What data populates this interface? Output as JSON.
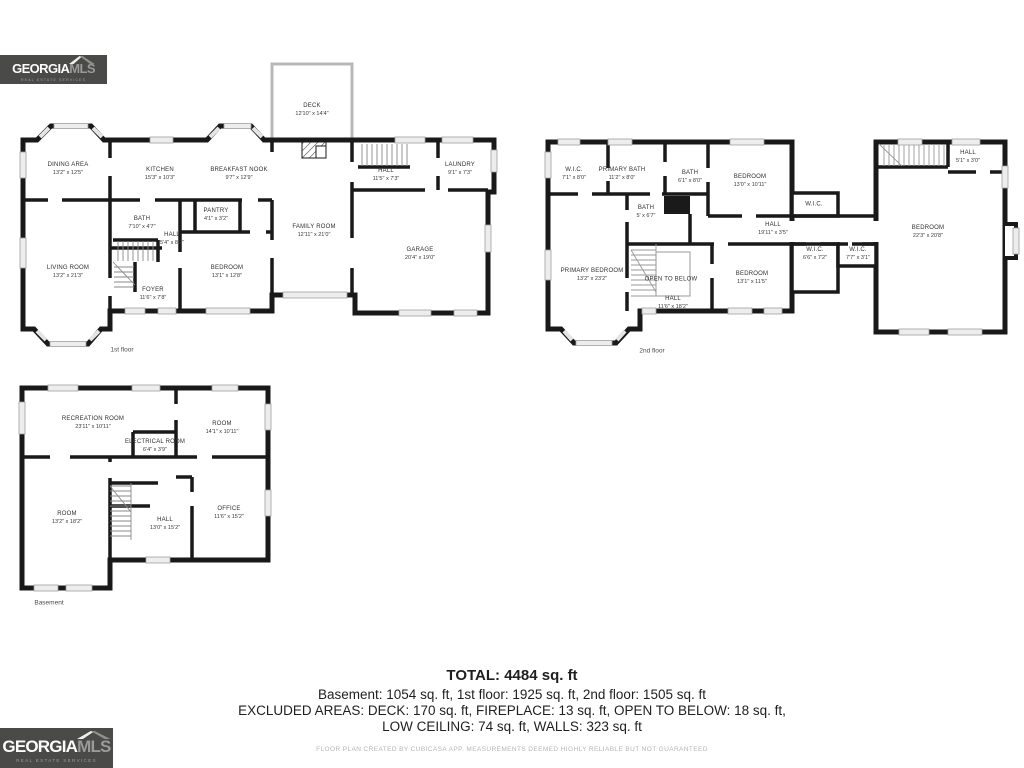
{
  "branding": {
    "georgia": "GEORGIA",
    "mls": "MLS",
    "tagline": "REAL ESTATE SERVICES"
  },
  "floors": [
    {
      "id": "first-floor",
      "caption": "1st floor",
      "rooms": [
        {
          "name": "DINING AREA",
          "dims": "13'2\" x 12'5\"",
          "x": 68,
          "y": 169
        },
        {
          "name": "KITCHEN",
          "dims": "15'3\" x 10'3\"",
          "x": 160,
          "y": 174
        },
        {
          "name": "BREAKFAST NOOK",
          "dims": "9'7\" x 12'9\"",
          "x": 239,
          "y": 174
        },
        {
          "name": "DECK",
          "dims": "12'10\" x 14'4\"",
          "x": 312,
          "y": 110
        },
        {
          "name": "HALL",
          "dims": "11'5\" x 7'3\"",
          "x": 386,
          "y": 175
        },
        {
          "name": "LAUNDRY",
          "dims": "9'1\" x 7'3\"",
          "x": 460,
          "y": 169
        },
        {
          "name": "BATH",
          "dims": "7'10\" x 4'7\"",
          "x": 142,
          "y": 223
        },
        {
          "name": "HALL",
          "dims": "5'4\" x 8'2\"",
          "x": 172,
          "y": 239
        },
        {
          "name": "PANTRY",
          "dims": "4'1\" x 3'2\"",
          "x": 216,
          "y": 215
        },
        {
          "name": "FAMILY ROOM",
          "dims": "12'11\" x 21'0\"",
          "x": 314,
          "y": 231
        },
        {
          "name": "GARAGE",
          "dims": "20'4\" x 19'0\"",
          "x": 420,
          "y": 254
        },
        {
          "name": "LIVING ROOM",
          "dims": "13'2\" x 21'3\"",
          "x": 68,
          "y": 272
        },
        {
          "name": "BEDROOM",
          "dims": "13'1\" x 12'8\"",
          "x": 227,
          "y": 272
        },
        {
          "name": "FOYER",
          "dims": "11'6\" x 7'8\"",
          "x": 153,
          "y": 294
        }
      ]
    },
    {
      "id": "second-floor",
      "caption": "2nd floor",
      "rooms": [
        {
          "name": "W.I.C.",
          "dims": "7'1\" x 8'0\"",
          "x": 574,
          "y": 174
        },
        {
          "name": "PRIMARY BATH",
          "dims": "11'2\" x 8'0\"",
          "x": 622,
          "y": 174
        },
        {
          "name": "BATH",
          "dims": "6'1\" x 8'0\"",
          "x": 690,
          "y": 177
        },
        {
          "name": "BEDROOM",
          "dims": "13'0\" x 10'11\"",
          "x": 750,
          "y": 181
        },
        {
          "name": "HALL",
          "dims": "5'1\" x 3'0\"",
          "x": 968,
          "y": 157
        },
        {
          "name": "BATH",
          "dims": "5' x 6'7\"",
          "x": 646,
          "y": 212
        },
        {
          "name": "HALL",
          "dims": "19'11\" x 3'5\"",
          "x": 773,
          "y": 229
        },
        {
          "name": "W.I.C.",
          "dims": "",
          "x": 814,
          "y": 205
        },
        {
          "name": "W.I.C.",
          "dims": "6'6\" x 7'2\"",
          "x": 815,
          "y": 254
        },
        {
          "name": "W.I.C.",
          "dims": "7'7\" x 3'1\"",
          "x": 858,
          "y": 254
        },
        {
          "name": "BEDROOM",
          "dims": "22'3\" x 20'8\"",
          "x": 928,
          "y": 232
        },
        {
          "name": "PRIMARY BEDROOM",
          "dims": "13'2\" x 23'2\"",
          "x": 592,
          "y": 275
        },
        {
          "name": "OPEN TO BELOW",
          "dims": "",
          "x": 671,
          "y": 280
        },
        {
          "name": "BEDROOM",
          "dims": "13'1\" x 11'5\"",
          "x": 752,
          "y": 278
        },
        {
          "name": "HALL",
          "dims": "11'6\" x 18'2\"",
          "x": 673,
          "y": 303
        }
      ]
    },
    {
      "id": "basement",
      "caption": "Basement",
      "rooms": [
        {
          "name": "RECREATION ROOM",
          "dims": "23'11\" x 10'11\"",
          "x": 93,
          "y": 423
        },
        {
          "name": "ROOM",
          "dims": "14'1\" x 10'11\"",
          "x": 222,
          "y": 428
        },
        {
          "name": "ELECTRICAL ROOM",
          "dims": "6'4\" x 3'9\"",
          "x": 155,
          "y": 446
        },
        {
          "name": "ROOM",
          "dims": "13'2\" x 18'2\"",
          "x": 67,
          "y": 518
        },
        {
          "name": "HALL",
          "dims": "13'0\" x 15'2\"",
          "x": 165,
          "y": 524
        },
        {
          "name": "OFFICE",
          "dims": "11'6\" x 15'2\"",
          "x": 229,
          "y": 513
        }
      ]
    }
  ],
  "summary": {
    "total": "TOTAL: 4484 sq. ft",
    "line1": "Basement: 1054 sq. ft, 1st floor: 1925 sq. ft, 2nd floor: 1505 sq. ft",
    "line2": "EXCLUDED AREAS: DECK: 170 sq. ft, FIREPLACE: 13 sq. ft, OPEN TO BELOW: 18 sq. ft,",
    "line3": "LOW CEILING: 74 sq. ft, WALLS: 323 sq. ft",
    "disclaimer": "FLOOR PLAN CREATED BY CUBICASA APP. MEASUREMENTS DEEMED HIGHLY RELIABLE BUT NOT GUARANTEED"
  }
}
